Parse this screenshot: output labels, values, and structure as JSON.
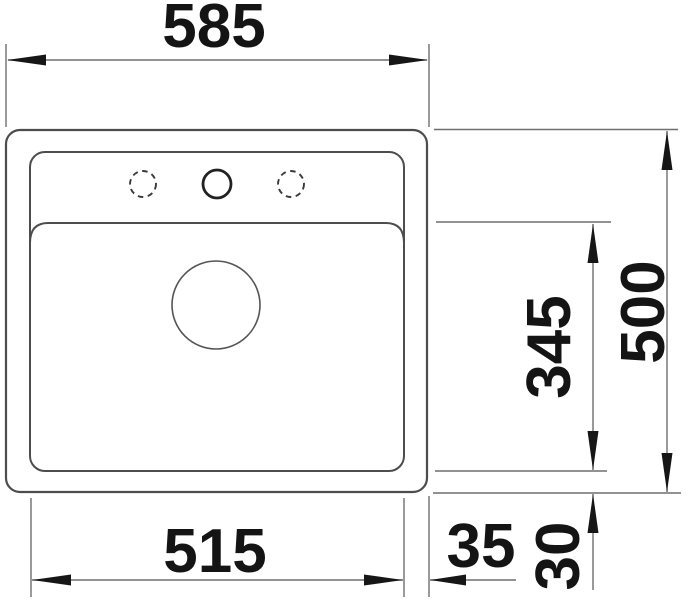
{
  "drawing": {
    "subject": "sink-top-view-installation-drawing",
    "dimensions": {
      "overall_width": "585",
      "cutout_width": "515",
      "side_rim_offset": "35",
      "bowl_length": "345",
      "overall_depth": "500",
      "bottom_rim_offset": "30"
    },
    "features": {
      "tap_holes": 3,
      "tap_hole_center_style": "solid",
      "tap_hole_side_style": "dashed",
      "drain": "round-centered"
    },
    "colors": {
      "background": "#ffffff",
      "outline": "#4d4d4d",
      "dimension_line": "#6f6f6f",
      "text": "#141414"
    }
  }
}
